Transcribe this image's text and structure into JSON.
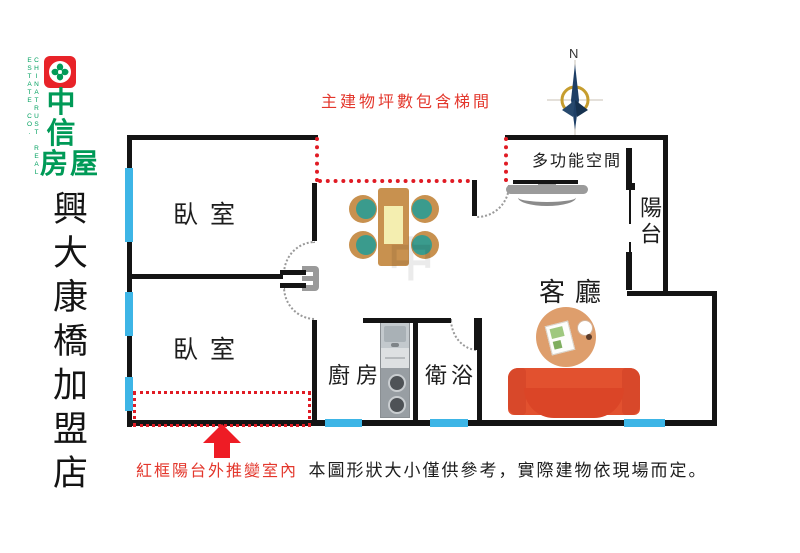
{
  "branding": {
    "company_en": "CHINATRUST REAL ESTATE CO.",
    "logo_parts": [
      "中",
      "信",
      "房屋"
    ],
    "store_name": "興大康橋加盟店",
    "brand_green": "#009a57",
    "brand_red": "#e82329"
  },
  "floorplan": {
    "top_note": "主建物坪數包含梯間",
    "bottom_note_red": "紅框陽台外推變室內",
    "bottom_note_black": "本圖形狀大小僅供參考，實際建物依現場而定。",
    "compass": {
      "label": "N"
    },
    "watermark": "中",
    "rooms": {
      "bedroom1": "臥室",
      "bedroom2": "臥室",
      "kitchen": "廚房",
      "bathroom": "衛浴",
      "living": "客廳",
      "multi": "多功能空間",
      "balcony": "陽台"
    },
    "colors": {
      "wall": "#141414",
      "window": "#3db5e6",
      "dashed_red": "#e01b24",
      "note_red": "#e3372c",
      "sofa": "#e2512f",
      "rug": "#de9e6c",
      "table": "#c8914f",
      "chair_seat": "#3a9b8d",
      "bench_gray": "#9b9b9b",
      "compass_navy": "#1e3f66",
      "compass_gold": "#c69d2e"
    },
    "icons": {
      "compass": "north-compass-icon",
      "arrow": "up-arrow-icon",
      "logo": "chinatrust-clover-icon"
    }
  }
}
